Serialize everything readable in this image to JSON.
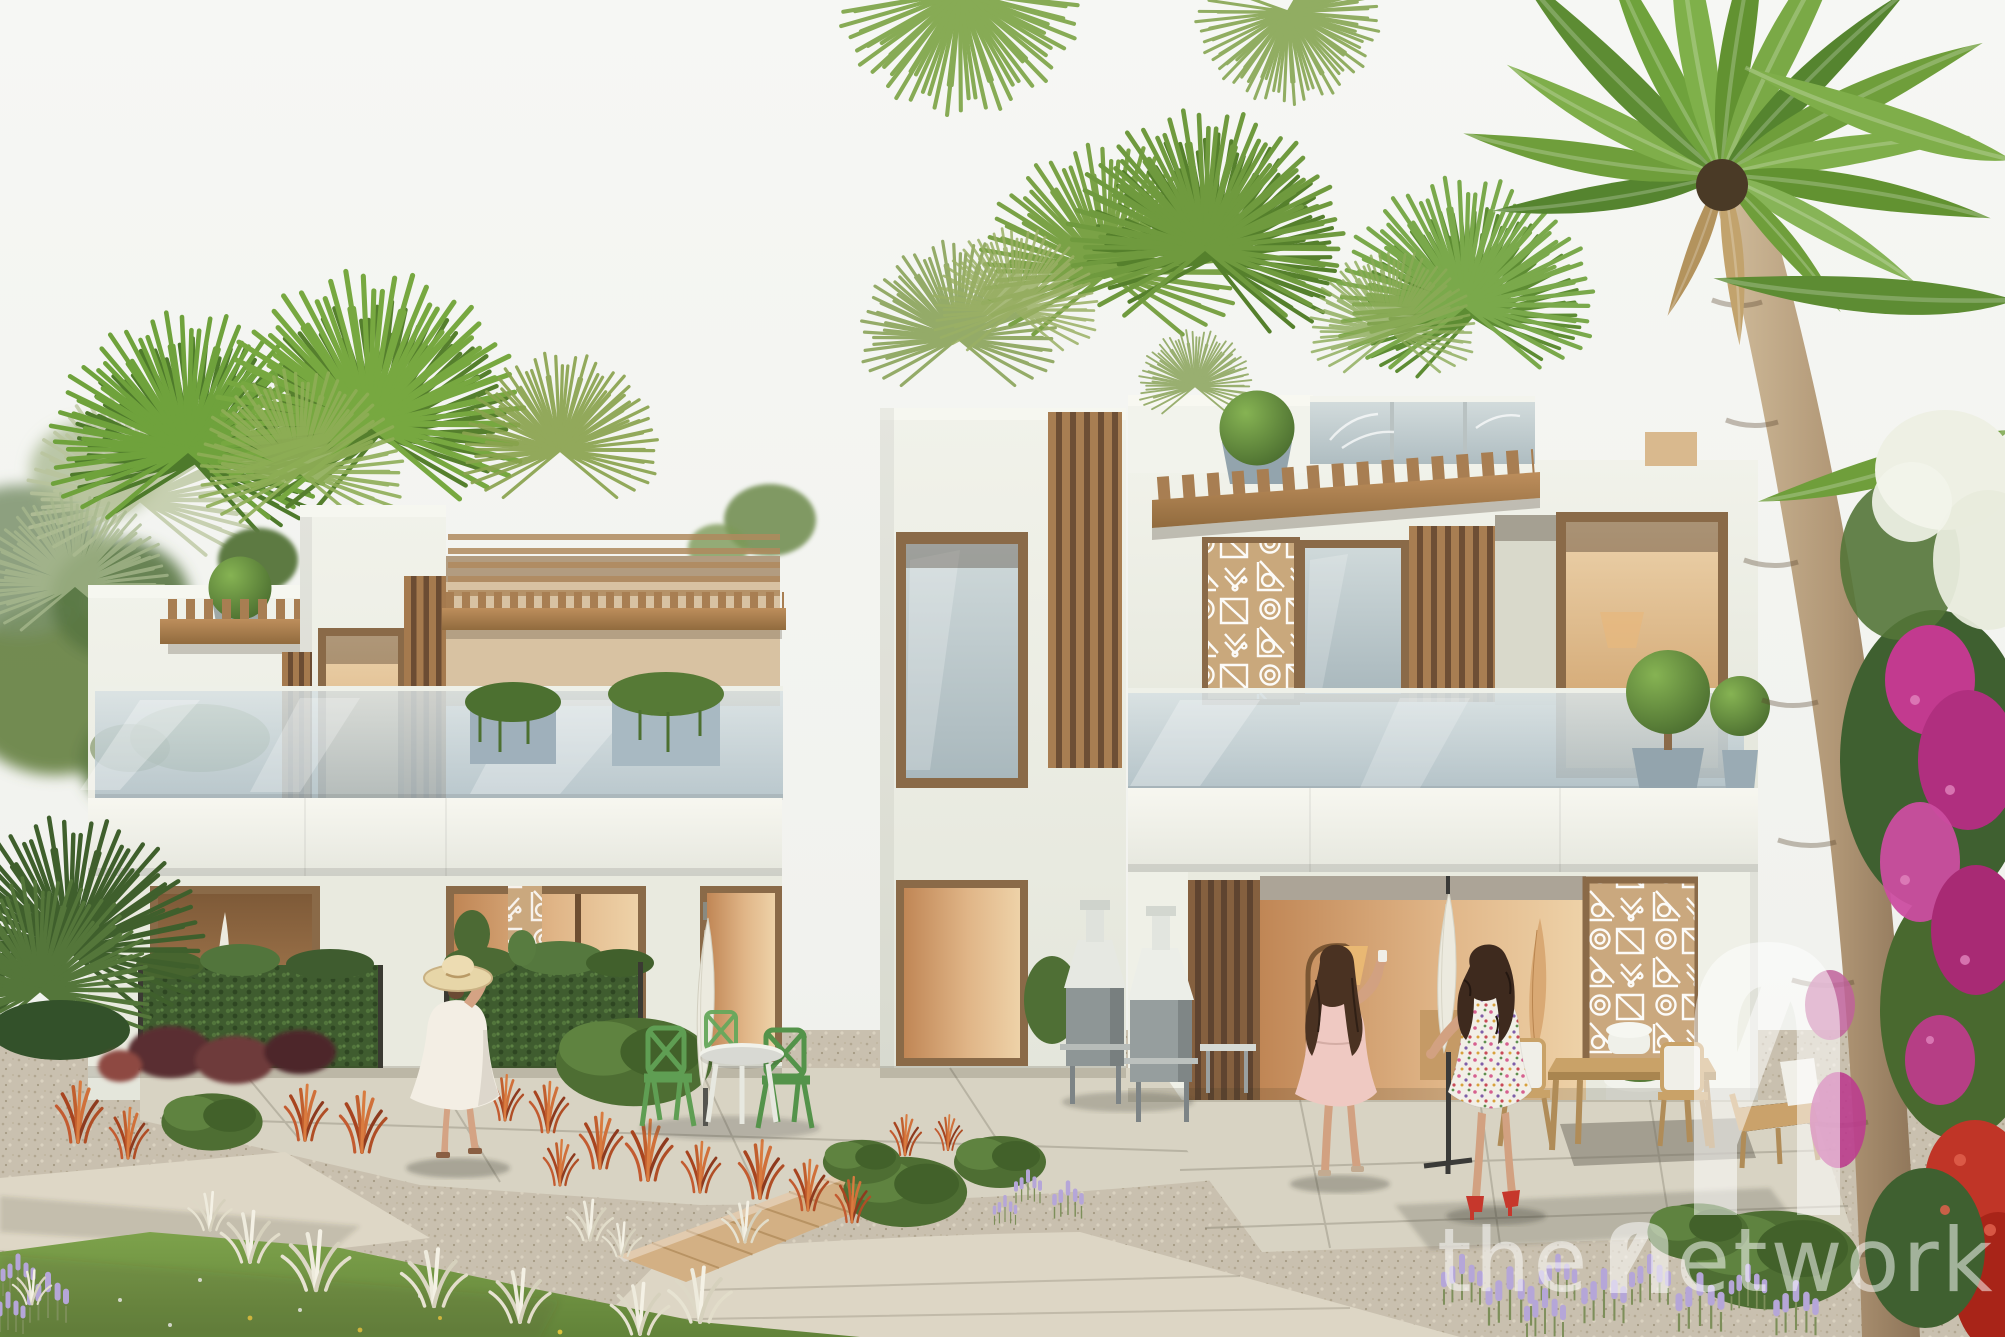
{
  "scene": {
    "subject": "Architectural rendering of modern two-storey townhouses with timber louvres and pergolas, landscaped gravel garden, outdoor furniture, three women walking, and palm trees",
    "watermark": {
      "text": "the network",
      "text_before_logo": "the",
      "text_after_logo": "etwork",
      "logo": "arch-n-monogram",
      "color": "#ffffff",
      "opacity": 0.5
    },
    "palette": {
      "sky": "#f3f4f0",
      "walls": "#eef0e7",
      "timber": "#a87e52",
      "timber_dark": "#6b4c33",
      "glass": "#b7c4c8",
      "interior_glow": "#d9ab77",
      "foliage_dark": "#3f5c2f",
      "palm_green": "#6fa23c",
      "gravel": "#c9c0af",
      "paving": "#ddd6c5",
      "deck_timber": "#d3b084",
      "lawn": "#7da24b",
      "ornamental_grass_red": "#c15f2e",
      "ornamental_grass_white": "#e9e5d6",
      "lavender": "#b5a6d8",
      "bougainvillea_magenta": "#c23a8f",
      "bougainvillea_white": "#eef0e4",
      "flowers_red": "#c03527",
      "dress_white": "#f3eee4",
      "dress_pink": "#efc9c2",
      "bistro_chair_green": "#5f9e53",
      "umbrella_white": "#eceadf",
      "umbrella_tan": "#d9a974"
    }
  }
}
